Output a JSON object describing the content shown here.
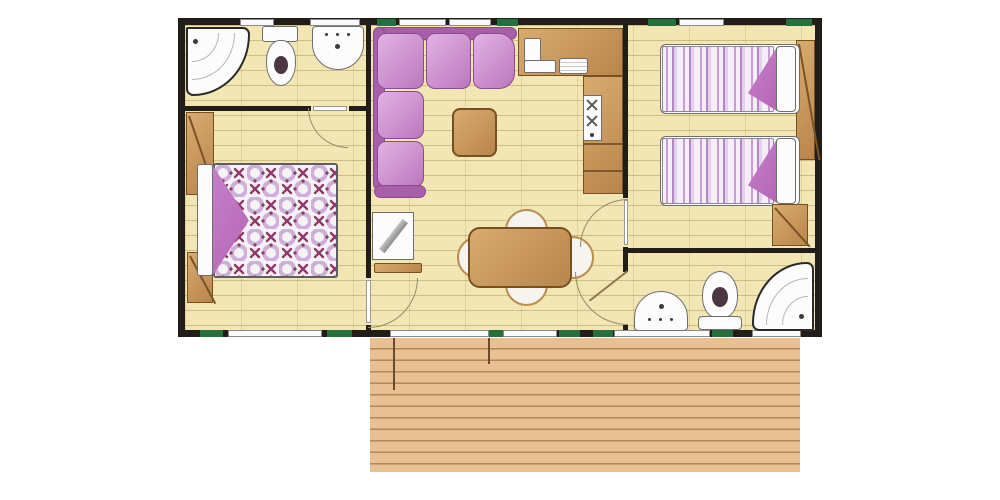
{
  "diagram": {
    "type": "floorplan",
    "subject": "mobile-home floor plan, top view, with exterior wooden deck terrace",
    "rooms": [
      {
        "id": "bathroom-left",
        "position": "top-left",
        "fixtures": [
          "corner-shower",
          "toilet",
          "washbasin"
        ]
      },
      {
        "id": "master-bedroom",
        "position": "left",
        "furniture": [
          "double-bed-patterned-quilt",
          "purple-blanket-fold",
          "wardrobe-upper",
          "wardrobe-lower"
        ]
      },
      {
        "id": "living-room",
        "position": "center",
        "furniture": [
          "l-shaped-corner-sofa",
          "coffee-table",
          "tv-unit",
          "tv-shelf",
          "dining-table",
          "chair-top",
          "chair-bottom",
          "chair-left",
          "chair-right"
        ]
      },
      {
        "id": "kitchen",
        "position": "center-right",
        "fixtures": [
          "counter-top",
          "l-shaped-sink",
          "drainer",
          "hob-two-burners",
          "counter-column"
        ]
      },
      {
        "id": "twin-bedroom",
        "position": "right",
        "furniture": [
          "single-bed-1-striped-quilt",
          "single-bed-2-striped-quilt",
          "pillow-1",
          "pillow-2",
          "wardrobe",
          "cabinet"
        ]
      },
      {
        "id": "bathroom-right",
        "position": "bottom-right",
        "fixtures": [
          "washbasin",
          "toilet",
          "corner-shower"
        ]
      },
      {
        "id": "deck-terrace",
        "position": "bottom-exterior",
        "furniture": []
      }
    ],
    "door_arcs": 4,
    "window_strips_top": 5,
    "window_strips_bottom": 5,
    "green_vent_marks": 9,
    "deck_divider_lines": 2
  },
  "colors": {
    "wall": "#211d18",
    "floor": "#f2e6b5",
    "green": "#25703c",
    "deck": "#e8c093",
    "brown": "#b9854c",
    "brown_light": "#d8ab6f",
    "brown_dark": "#77501f",
    "sofa_light": "#e2b2e4",
    "sofa_mid": "#bb77bd",
    "sofa_dark": "#a75fa9",
    "sofa_border": "#8c4b8e",
    "purple_fold": "#b366b5",
    "table_edge": "#b98d4f",
    "arc_line": "#9a8a66",
    "quilt_x": "#8f3a66",
    "quilt_swirl": "#cdafd7"
  }
}
